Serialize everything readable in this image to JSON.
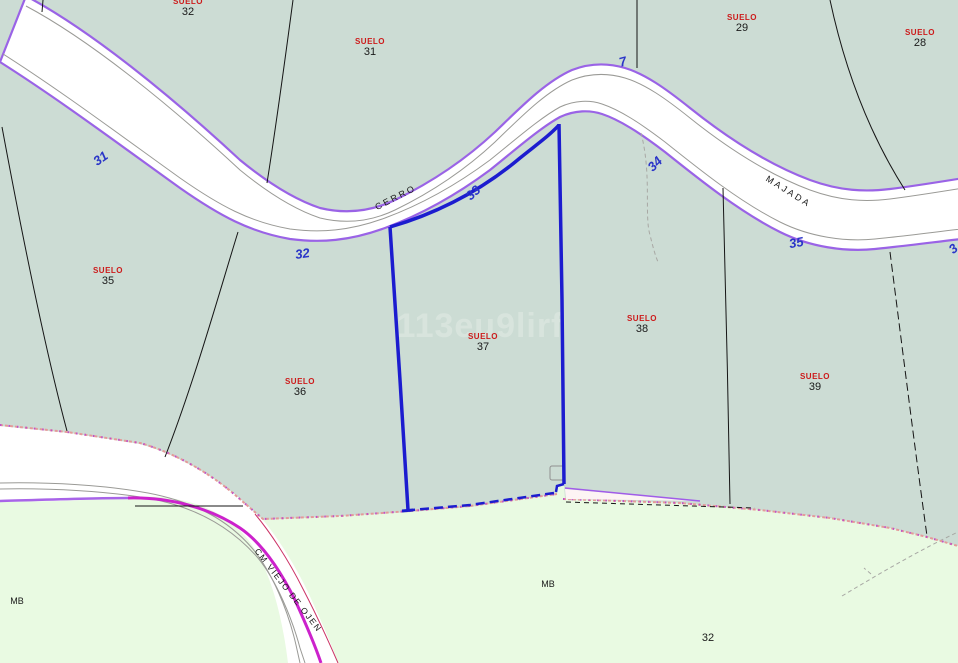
{
  "watermark": {
    "text": "113eu9lirf"
  },
  "map": {
    "colors": {
      "urban_fill": "#ccdcd4",
      "rustic_fill": "#e9fae2",
      "road_edge_purple": "#9a63e6",
      "road_casing_gray": "#9a9a96",
      "boundary_dot_pink": "#e49a9a",
      "boundary_dot_magenta": "#c050c8",
      "selected_parcel_blue": "#1c1ccf",
      "road_magenta": "#cc22cc",
      "road_crimson": "#cc3366",
      "parcel_label_red": "#cc1a1a",
      "road_number_blue": "#2a35c8",
      "line_black": "#151515",
      "watermark_gray": "#e2ece6"
    },
    "parcel_labels": [
      {
        "tag": "SUELO",
        "number": "32",
        "x": 188,
        "y": 4
      },
      {
        "tag": "SUELO",
        "number": "31",
        "x": 370,
        "y": 44
      },
      {
        "tag": "SUELO",
        "number": "29",
        "x": 742,
        "y": 20
      },
      {
        "tag": "SUELO",
        "number": "28",
        "x": 920,
        "y": 35
      },
      {
        "tag": "SUELO",
        "number": "35",
        "x": 108,
        "y": 273
      },
      {
        "tag": "SUELO",
        "number": "36",
        "x": 300,
        "y": 384
      },
      {
        "tag": "SUELO",
        "number": "37",
        "x": 483,
        "y": 339
      },
      {
        "tag": "SUELO",
        "number": "38",
        "x": 642,
        "y": 321
      },
      {
        "tag": "SUELO",
        "number": "39",
        "x": 815,
        "y": 379
      }
    ],
    "road_numbers": [
      {
        "text": "31",
        "x": 103,
        "y": 162,
        "rot": -35
      },
      {
        "text": "32",
        "x": 303,
        "y": 258,
        "rot": -8
      },
      {
        "text": "33",
        "x": 476,
        "y": 196,
        "rot": -42
      },
      {
        "text": "7",
        "x": 624,
        "y": 66,
        "rot": -15
      },
      {
        "text": "34",
        "x": 658,
        "y": 167,
        "rot": -45
      },
      {
        "text": "35",
        "x": 797,
        "y": 247,
        "rot": -10
      },
      {
        "text": "3",
        "x": 956,
        "y": 252,
        "rot": -40
      }
    ],
    "road_names": [
      {
        "text": "CERRO",
        "x": 397,
        "y": 200,
        "rot": -27,
        "small": false
      },
      {
        "text": "MAJADA",
        "x": 787,
        "y": 194,
        "rot": 32,
        "small": false
      },
      {
        "text": "CM VIEJO DE OJEN",
        "x": 286,
        "y": 592,
        "rot": 52,
        "small": true
      }
    ],
    "area_labels": [
      {
        "text": "MB",
        "x": 17,
        "y": 604,
        "size": "small"
      },
      {
        "text": "MB",
        "x": 548,
        "y": 587,
        "size": "small"
      },
      {
        "text": "32",
        "x": 708,
        "y": 641,
        "size": "num"
      }
    ]
  }
}
